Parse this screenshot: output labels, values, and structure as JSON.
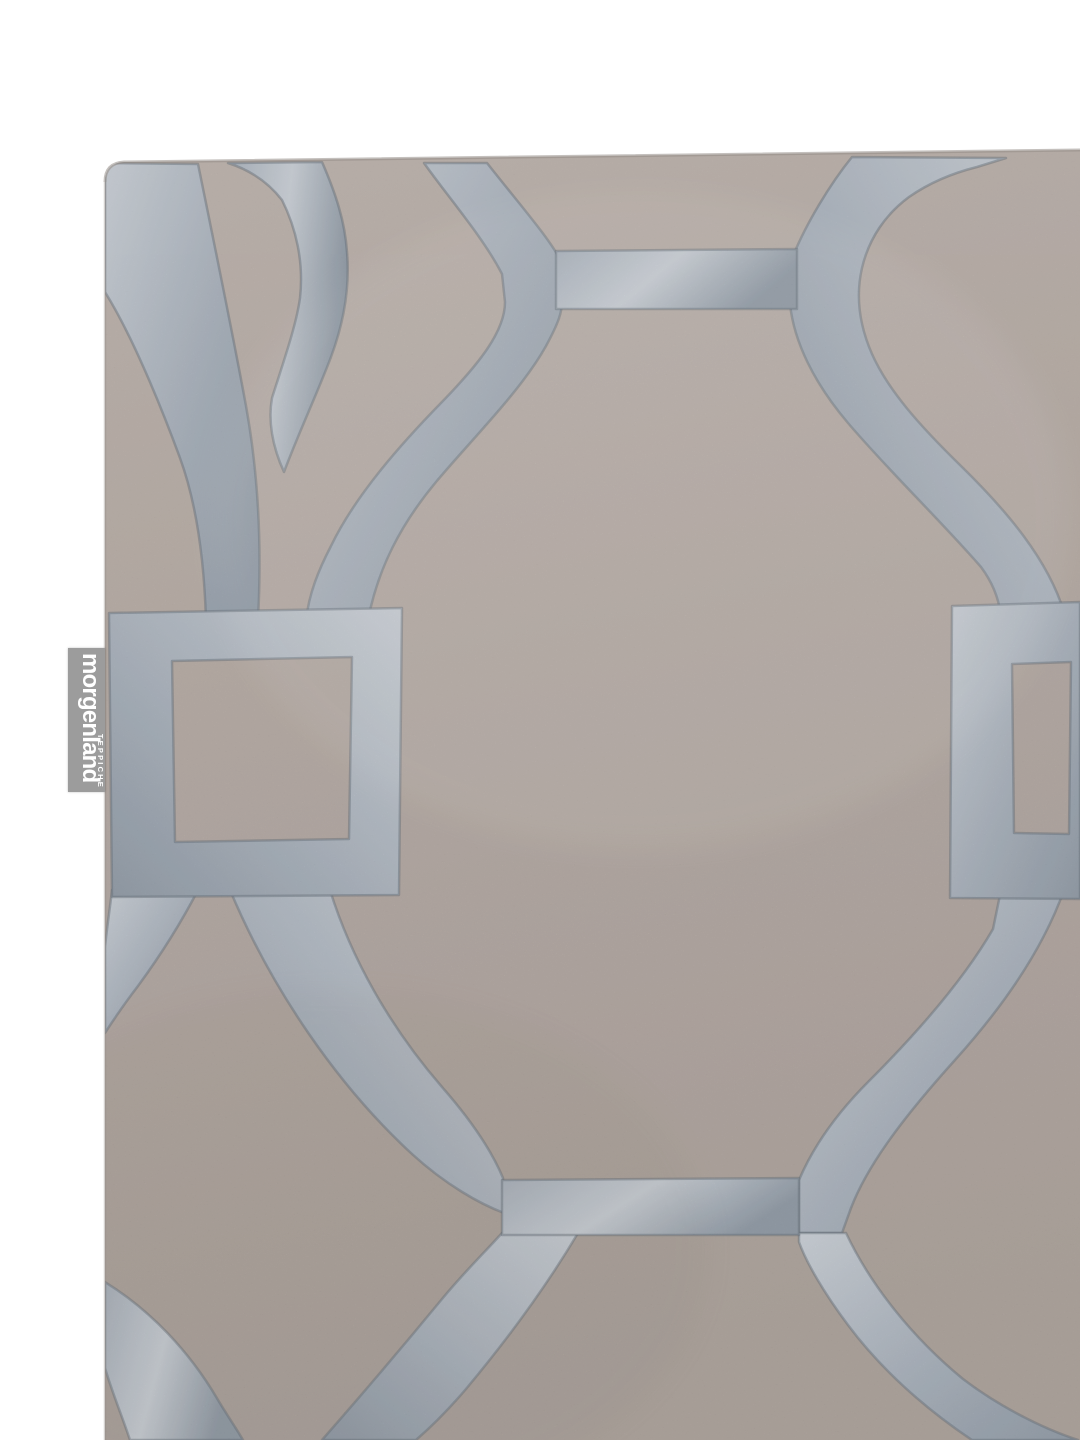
{
  "page": {
    "background_color": "#ffffff"
  },
  "photo": {
    "type": "product-photo",
    "alt": "Cropped corner view of a hand-tufted rug in taupe with a silver-grey geometric trellis pattern of large interlocking circles joined by link bars and square knots"
  },
  "label": {
    "brand": "morgenland",
    "subtitle": "TEPPICHE",
    "background_color": "#9c9c9c",
    "text_color": "#ffffff"
  },
  "rug": {
    "colors": {
      "pile_light": "#bdb2ab",
      "pile_base": "#b4a8a1",
      "pile_dark": "#aa9f98",
      "silver_light": "#cad0d7",
      "silver_base": "#a8b1bc",
      "silver_dark": "#8c97a3",
      "carve_line": "#5a6570",
      "edge_shadow": "#948c86"
    }
  }
}
